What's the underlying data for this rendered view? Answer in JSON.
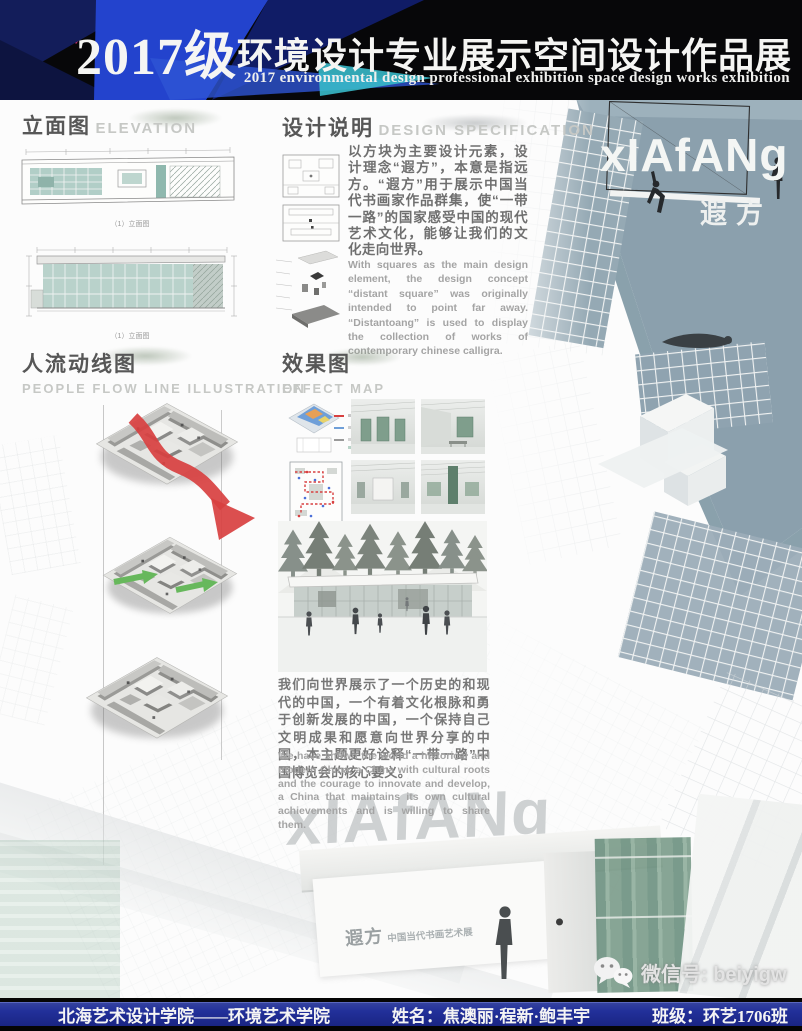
{
  "header": {
    "title_prefix": "2017级",
    "title_rest": "环境设计专业展示空间设计作品展",
    "subtitle": "2017 environmental design professional exhibition space design works exhibition"
  },
  "elevation": {
    "title_cn": "立面图",
    "title_en": "ELEVATION",
    "caption_a": "（1）立面图",
    "caption_b": "（1）立面图"
  },
  "design_spec": {
    "title_cn": "设计说明",
    "title_en": "DESIGN SPECIFICATION",
    "body_cn": "以方块为主要设计元素，设计理念“遐方”，本意是指远方。“遐方”用于展示中国当代书画家作品群集，使“一带一路”的国家感受中国的现代艺术文化，能够让我们的文化走向世界。",
    "body_en": "With squares as the main design element, the design concept “distant square” was originally intended to point far away. “Distantoang” is used to display the collection of works of contemporary chinese calligra."
  },
  "flow": {
    "title_cn": "人流动线图",
    "title_en": "PEOPLE FLOW LINE ILLUSTRATION"
  },
  "effect": {
    "title_cn": "效果图",
    "title_en": "EFFECT MAP",
    "body_cn": "我们向世界展示了一个历史的和现代的中国，一个有着文化根脉和勇于创新发展的中国，一个保持自己文明成果和愿意向世界分享的中国，本主题更好诠释“一带一路”中国博览会的核心要义。",
    "body_en": "We have shown the world a historical and modern China, a China with cultural roots and the courage to innovate and develop, a China that maintains its own cultural achievements and is willing to share them."
  },
  "branding": {
    "logo_en": "xIAfANg",
    "logo_cn": "遐方",
    "watermark": "xIAfANg",
    "wall_title": "遐方",
    "wall_subtitle": "中国当代书画艺术展"
  },
  "wechat": {
    "label": "微信号: beiyigw"
  },
  "footer": {
    "school": "北海艺术设计学院——环境艺术学院",
    "names": "姓名：焦澳丽·程新·鲍丰宇",
    "class_name": "班级：环艺1706班"
  },
  "colors": {
    "header_bg": "#070709",
    "header_blue": "#2343cd",
    "header_navy": "#121d5e",
    "header_pink": "#df2a6e",
    "header_cyan": "#39b9c9",
    "footer_navy": "#22309a",
    "arrow_red": "#d84040",
    "arrow_green": "#67b85c",
    "building_bluegray": "#8ba0ad",
    "drawing_teal": "#a9c9c1"
  }
}
